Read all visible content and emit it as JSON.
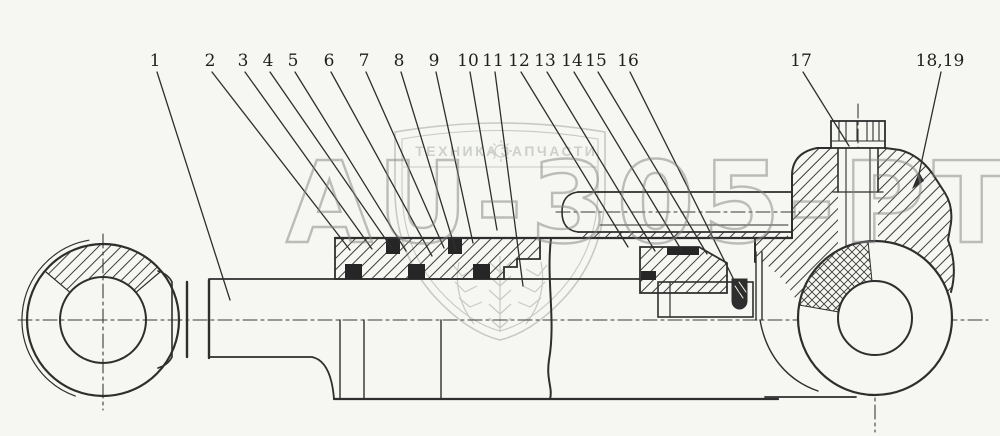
{
  "diagram": {
    "type": "technical-drawing",
    "subject": "Hydraulic cylinder assembly, sectional view with numbered parts",
    "callouts": [
      "1",
      "2",
      "3",
      "4",
      "5",
      "6",
      "7",
      "8",
      "9",
      "10",
      "11",
      "12",
      "13",
      "14",
      "15",
      "16",
      "17",
      "18,19"
    ]
  },
  "watermark": {
    "text": "AU-305-PT"
  },
  "brand": {
    "left": "ТЕХНИКА",
    "right": "ЗАПЧАСТИ"
  },
  "colors": {
    "paper": "#f6f6f2",
    "line": "#2e2e2e",
    "watermark_gray": "#828282",
    "brand_gray": "#aab1aa"
  }
}
